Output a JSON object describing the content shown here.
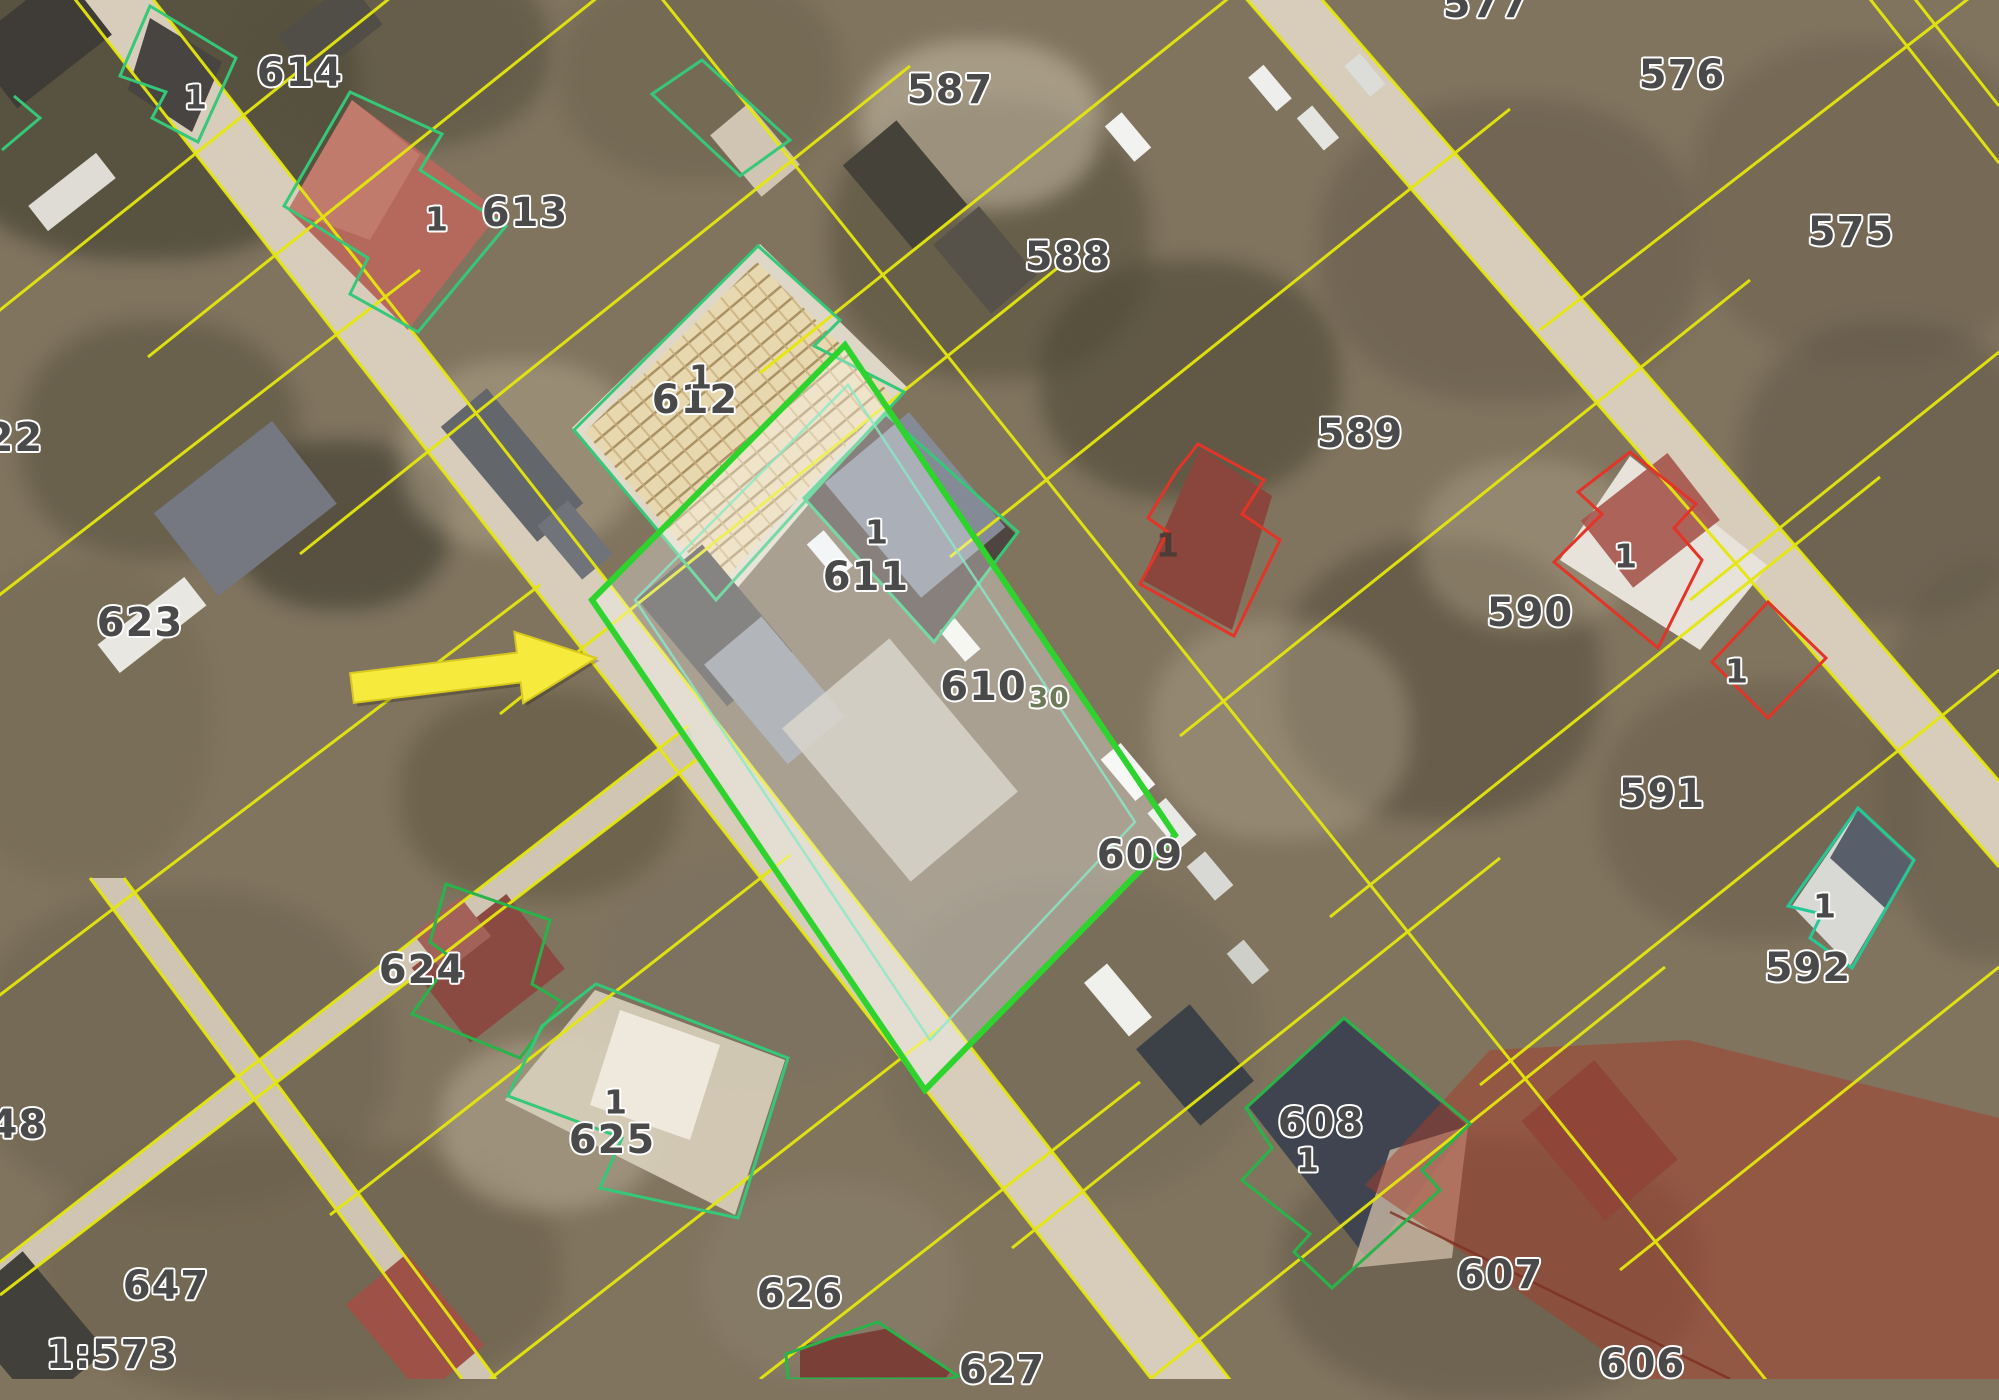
{
  "scale_text": "1:573",
  "highlight": {
    "parcel": "610",
    "sub_label": "30"
  },
  "parcel_labels": {
    "p577": "577",
    "p576": "576",
    "p575": "575",
    "p587": "587",
    "p588": "588",
    "p589": "589",
    "p590": "590",
    "p591": "591",
    "p592": "592",
    "p614": "614",
    "p613": "613",
    "p612": "612",
    "p611": "611",
    "p609": "609",
    "p608": "608",
    "p607": "607",
    "p606": "606",
    "p622": "622",
    "p623": "623",
    "p624": "624",
    "p625": "625",
    "p626": "626",
    "p627": "627",
    "p647": "647",
    "p648": "648"
  },
  "building_marks": {
    "m614": "1",
    "m613": "1",
    "m612": "1",
    "m611": "1",
    "m589b": "1",
    "m590b": "1",
    "m590s": "1",
    "m592": "1",
    "m625": "1",
    "m608": "1"
  },
  "colors": {
    "parcel_line_yellow": "#e6e70c",
    "selected_parcel_green": "#2ed32e",
    "building_outline_teal": "#35c878",
    "building_outline_green": "#28b44b",
    "building_outline_red": "#e23427",
    "restriction_overlay_red": "#a53c2a",
    "arrow_yellow": "#f6ea3d"
  }
}
